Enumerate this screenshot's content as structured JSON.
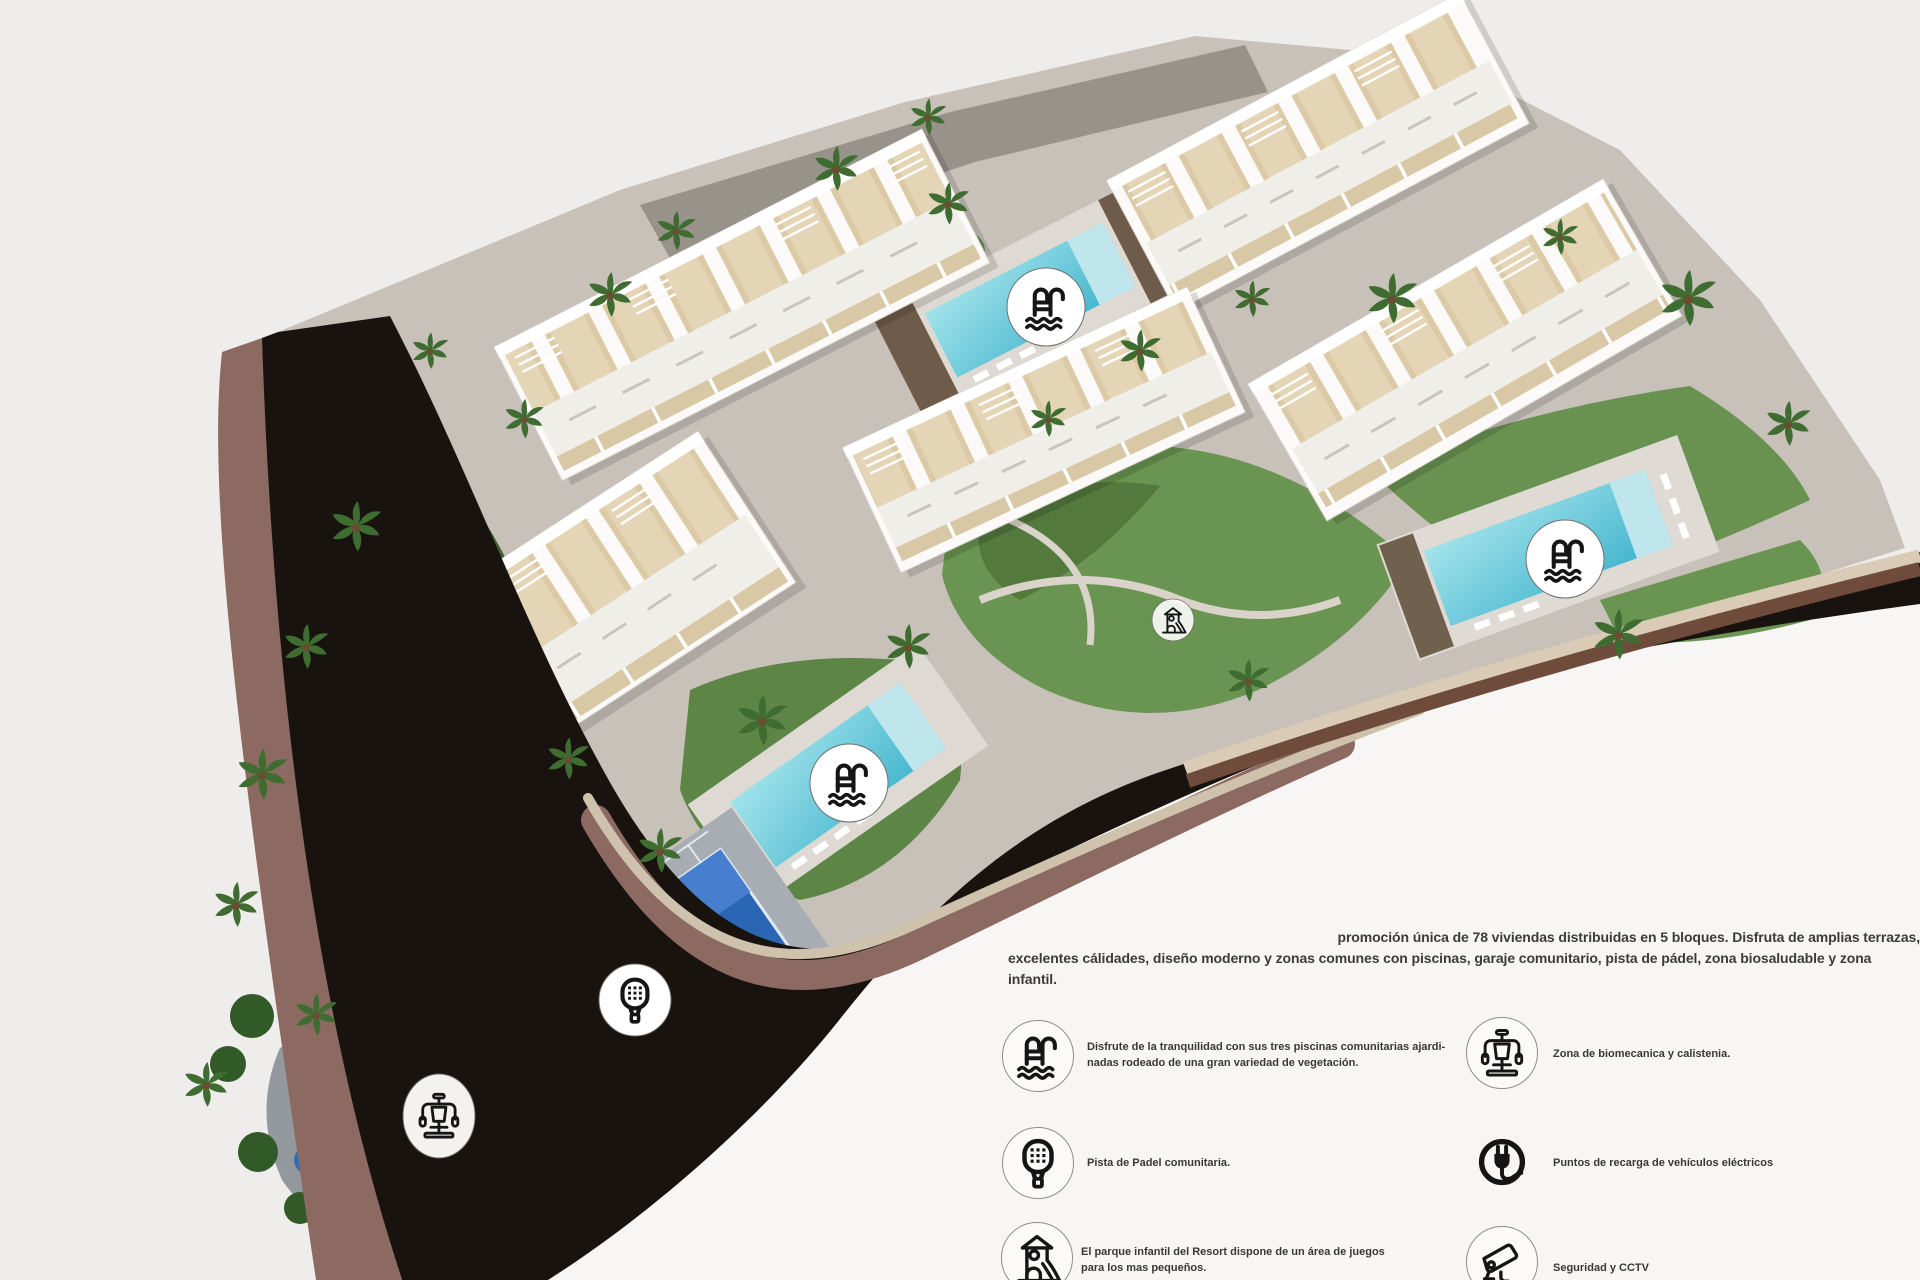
{
  "colors": {
    "background": "#efedeb",
    "outer_white_zone": "#f7f6f4",
    "road_asphalt": "#18130f",
    "road_sidewalk_mauve": "#8d6a61",
    "retaining_wall_beige": "#d9cbb6",
    "retaining_wall_brown": "#6f4b3c",
    "site_pavement": "#c7c1b9",
    "grass": "#689150",
    "dense_vegetation": "#3c6330",
    "pool_water": "#54c0d4",
    "padel_court_blue": "#2b66b4",
    "playground_blue": "#2e6db3",
    "playground_red": "#c9513d",
    "building_white": "#fbfaf8",
    "terrace_beige": "#dccaa7",
    "text": "#3c3b39",
    "icon_black": "#151515"
  },
  "intro": {
    "lines": [
      "promoción única de 78 viviendas distribuidas en 5 bloques. Disfruta de amplias terrazas,",
      "excelentes cálidades, diseño moderno y zonas comunes con piscinas, garaje comunitario, pista de pádel, zona biosaludable y zona",
      "infantil."
    ]
  },
  "legend": {
    "left": [
      {
        "icon": "pool-ladder-icon",
        "lines": [
          "Disfrute de la tranquilidad con sus tres piscinas comunitarias ajardi-",
          "nadas rodeado de una gran variedad de vegetación."
        ]
      },
      {
        "icon": "padel-racket-icon",
        "lines": [
          "Pista de Padel comunitaria."
        ]
      },
      {
        "icon": "playground-icon",
        "lines": [
          "El parque infantil del Resort dispone de un área de juegos",
          "para los mas pequeños."
        ]
      }
    ],
    "right": [
      {
        "icon": "biomechanics-icon",
        "lines": [
          "Zona de biomecanica y calistenia."
        ]
      },
      {
        "icon": "ev-plug-icon",
        "lines": [
          "Puntos de recarga de vehículos eléctricos"
        ]
      },
      {
        "icon": "cctv-icon",
        "lines": [
          "Seguridad y CCTV"
        ]
      }
    ]
  },
  "map_badges": [
    {
      "id": "pool-north-badge",
      "icon": "pool-ladder-icon"
    },
    {
      "id": "pool-east-badge",
      "icon": "pool-ladder-icon"
    },
    {
      "id": "pool-south-badge",
      "icon": "pool-ladder-icon"
    },
    {
      "id": "playground-garden-badge",
      "icon": "playground-icon"
    },
    {
      "id": "padel-court-badge",
      "icon": "padel-racket-icon"
    },
    {
      "id": "calisthenics-area-badge",
      "icon": "biomechanics-icon"
    }
  ]
}
